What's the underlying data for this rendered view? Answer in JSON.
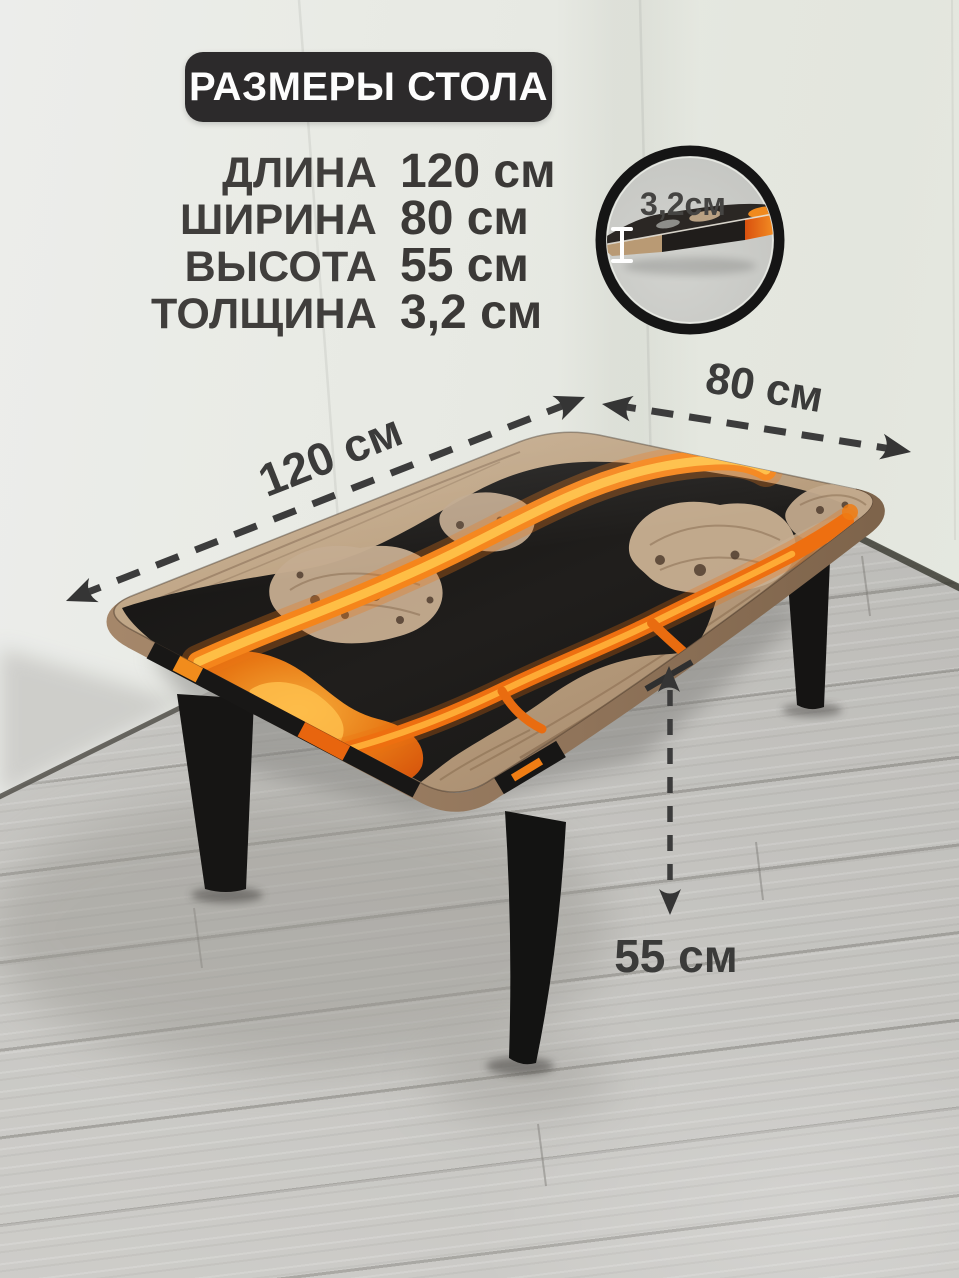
{
  "badge": {
    "title": "РАЗМЕРЫ СТОЛА"
  },
  "specs": {
    "rows": [
      {
        "label": "ДЛИНА",
        "value": "120 см"
      },
      {
        "label": "ШИРИНА",
        "value": "80 см"
      },
      {
        "label": "ВЫСОТА",
        "value": "55 см"
      },
      {
        "label": "ТОЛЩИНА",
        "value": "3,2 см"
      }
    ]
  },
  "annotations": {
    "length": "120 см",
    "width": "80 см",
    "height": "55 см",
    "thickness": "3,2см"
  },
  "colors": {
    "badge_bg": "#2c2a2b",
    "badge_text": "#fdfdfd",
    "spec_text": "#403e3c",
    "dimension_text": "#3b3b3a",
    "dash": "#3c3c3c",
    "resin_black": "#171615",
    "resin_orange": "#f1821a",
    "resin_yellow": "#ffc14e",
    "wood": "#b79d80",
    "leg_black": "#151413",
    "wall": "#e7e9e3",
    "floor": "#c8c7c3"
  }
}
